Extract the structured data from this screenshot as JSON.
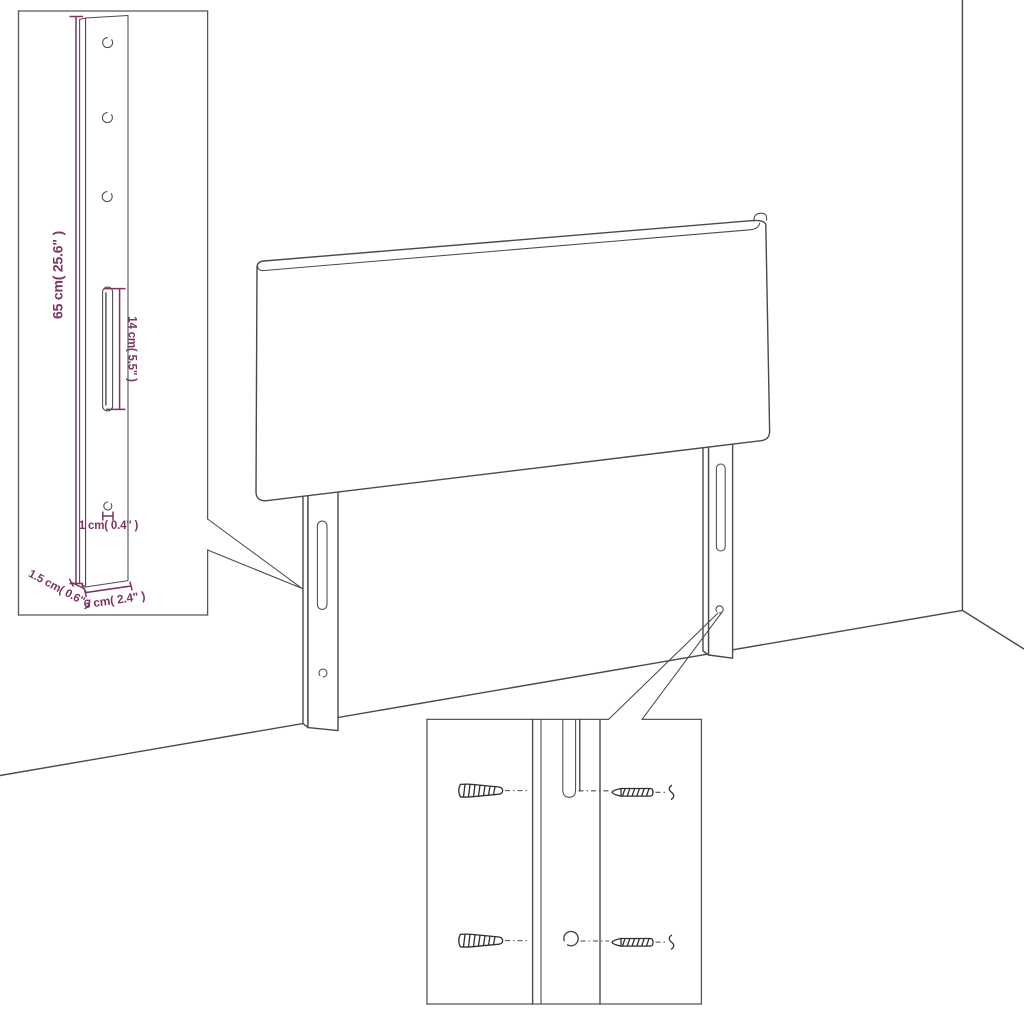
{
  "diagram_type": "product-dimension-diagram",
  "subject": "upholstered headboard with two adjustable mounting legs shown against a room corner",
  "colors": {
    "outline_gray": "#4a4a4a",
    "inset_border_gray": "#585858",
    "dimension_magenta": "#7e3363",
    "hardware_dark": "#2f2f2f",
    "background": "#ffffff"
  },
  "leg_dimension_inset": {
    "labels": {
      "height": "65 cm( 25.6\" )",
      "slot": "14 cm( 5.5\" )",
      "hole": "1 cm( 0.4\" )",
      "thickness": "1.5 cm( 0.6\" )",
      "width": "6 cm( 2.4\" )"
    }
  },
  "hardware_inset": {
    "contents": [
      "wall-plug",
      "screw",
      "mounting-slot",
      "mounting-hole"
    ]
  }
}
